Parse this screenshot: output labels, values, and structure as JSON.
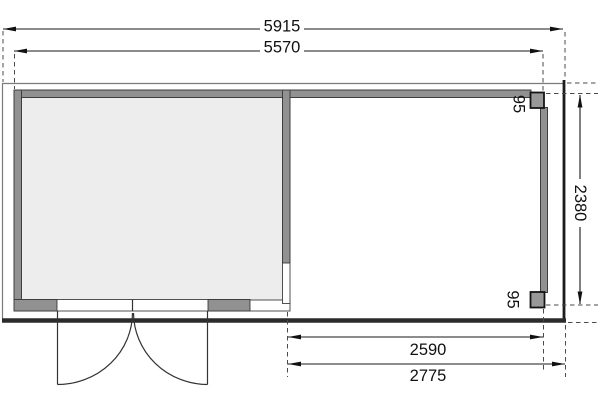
{
  "plan": {
    "dims": {
      "overall_width": "5915",
      "cabin_width": "5570",
      "overall_depth": "2380",
      "post_top": "95",
      "post_bottom": "95",
      "annex_inner_width": "2590",
      "annex_outer_width": "2775"
    },
    "colors": {
      "wall_fill": "#919191",
      "post_fill": "#989898",
      "room_fill": "#ededed",
      "opening_fill": "#ffffff",
      "floor_edge": "#2b2b2b",
      "roof_outline": "#7a7a7a",
      "dim_color": "#111111"
    }
  }
}
